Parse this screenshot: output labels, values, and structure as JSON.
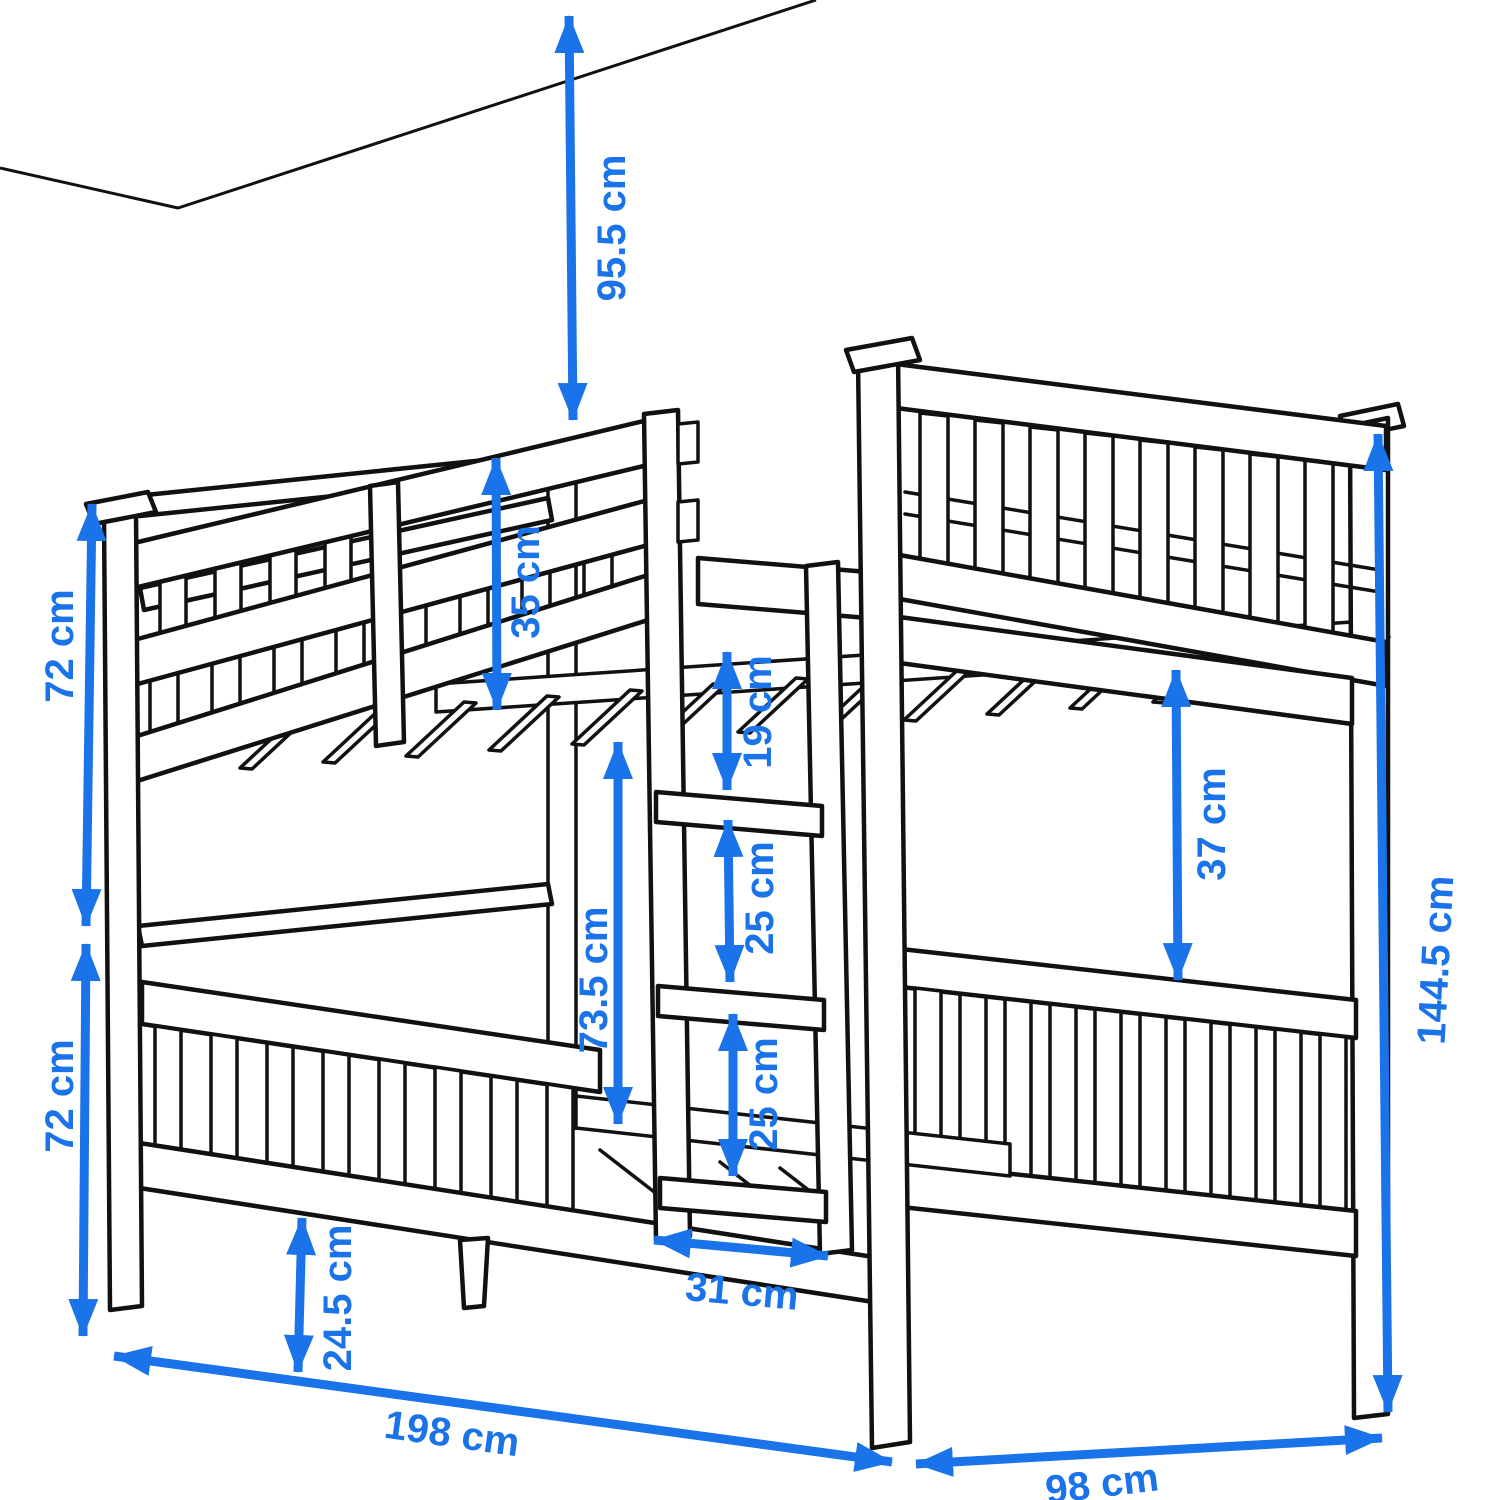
{
  "diagram": {
    "kind": "bunk-bed-dimension-diagram",
    "unit": "cm",
    "view": "perspective line drawing with ceiling corner at top left"
  },
  "colors": {
    "dimension_blue": "#1a73e8",
    "line_black": "#111111",
    "background": "#ffffff"
  },
  "dimensions": {
    "ceiling_to_bed": {
      "label": "95.5 cm",
      "value": 95.5,
      "meaning": "clearance from top bunk to ceiling"
    },
    "guard_rail": {
      "label": "35 cm",
      "value": 35,
      "meaning": "upper guard rail height above deck"
    },
    "upper_bunk_side": {
      "label": "72 cm",
      "value": 72,
      "meaning": "upper section height, left side"
    },
    "lower_bunk_side": {
      "label": "72 cm",
      "value": 72,
      "meaning": "lower section height, left side"
    },
    "leg_height": {
      "label": "24.5 cm",
      "value": 24.5,
      "meaning": "underbed leg clearance"
    },
    "length": {
      "label": "198 cm",
      "value": 198,
      "meaning": "overall bed length"
    },
    "width": {
      "label": "98 cm",
      "value": 98,
      "meaning": "overall bed width"
    },
    "total_height": {
      "label": "144.5 cm",
      "value": 144.5,
      "meaning": "overall bed height"
    },
    "clearance_right": {
      "label": "37 cm",
      "value": 37,
      "meaning": "gap upper deck to lower rail, head end"
    },
    "slat_to_rung": {
      "label": "19 cm",
      "value": 19,
      "meaning": "upper deck to first ladder rung"
    },
    "rung_gap_1": {
      "label": "25 cm",
      "value": 25,
      "meaning": "ladder rung spacing"
    },
    "rung_gap_2": {
      "label": "25 cm",
      "value": 25,
      "meaning": "ladder rung spacing"
    },
    "bunk_clearance": {
      "label": "73.5 cm",
      "value": 73.5,
      "meaning": "clearance between bunks"
    },
    "ladder_width": {
      "label": "31 cm",
      "value": 31,
      "meaning": "ladder width"
    }
  }
}
